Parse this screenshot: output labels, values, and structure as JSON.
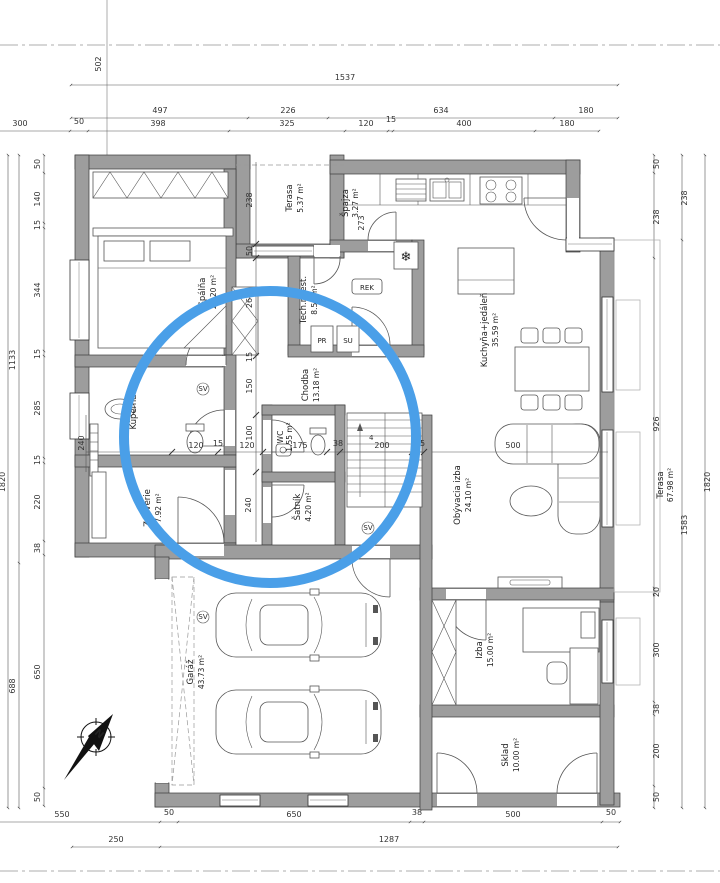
{
  "annotation": {
    "circle_color": "#4a9fe8"
  },
  "compass": {
    "north_label": "N"
  },
  "boxes": {
    "rek": "REK",
    "pr": "PR",
    "su": "SU",
    "sv": "SV",
    "freezer_icon": "❄",
    "stair_count": "4"
  },
  "rooms": {
    "spalna": {
      "name": "Spálňa",
      "area": "21.20 m²"
    },
    "terasa_small": {
      "name": "Terasa",
      "area": "5.37 m²"
    },
    "spajza": {
      "name": "Špajza",
      "area": "3.27 m²"
    },
    "kuchyna": {
      "name": "Kuchyňa+jedáleň",
      "area": "35.59 m²"
    },
    "tech": {
      "name": "Tech.miest.",
      "area": "8.50 m²"
    },
    "chodba": {
      "name": "Chodba",
      "area": "13.18 m²"
    },
    "kupelna": {
      "name": "Kúpeľňa",
      "area": ""
    },
    "wc": {
      "name": "WC",
      "area": "1.55 m²"
    },
    "satnik": {
      "name": "Šatník",
      "area": "4.20 m²"
    },
    "zadverie": {
      "name": "Zádverie",
      "area": "7.92 m²"
    },
    "obyvacia": {
      "name": "Obývacia izba",
      "area": "24.10 m²"
    },
    "izba": {
      "name": "Izba",
      "area": "15.00 m²"
    },
    "sklad": {
      "name": "Sklad",
      "area": "10.00 m²"
    },
    "garaz": {
      "name": "Garáž",
      "area": "43.73 m²"
    },
    "terasa_big": {
      "name": "Terasa",
      "area": "67.98 m²"
    }
  },
  "dims": {
    "ref_offset": "502",
    "top_row1": [
      "1537"
    ],
    "top_row2": [
      "497",
      "226",
      "634",
      "180"
    ],
    "top_row3": [
      "300",
      "50",
      "398",
      "325",
      "120",
      "15",
      "400",
      "180"
    ],
    "left_outer": [
      "1820"
    ],
    "left_mid": [
      "1133",
      "688"
    ],
    "left_inner": [
      "50",
      "140",
      "15",
      "344",
      "15",
      "285",
      "15",
      "220",
      "38",
      "650",
      "50"
    ],
    "right_inner": [
      "50",
      "238",
      "926",
      "20",
      "300",
      "38",
      "200",
      "50"
    ],
    "right_mid": [
      "238",
      "1583"
    ],
    "right_outer": [
      "1820"
    ],
    "bottom_row1": [
      "550",
      "50",
      "650",
      "38",
      "500",
      "50"
    ],
    "bottom_row2": [
      "250",
      "1287"
    ],
    "interior": [
      "238",
      "50",
      "273",
      "26",
      "15",
      "150",
      "100",
      "240",
      "120",
      "15",
      "120",
      "175",
      "38",
      "200",
      "15",
      "240",
      "500"
    ]
  }
}
